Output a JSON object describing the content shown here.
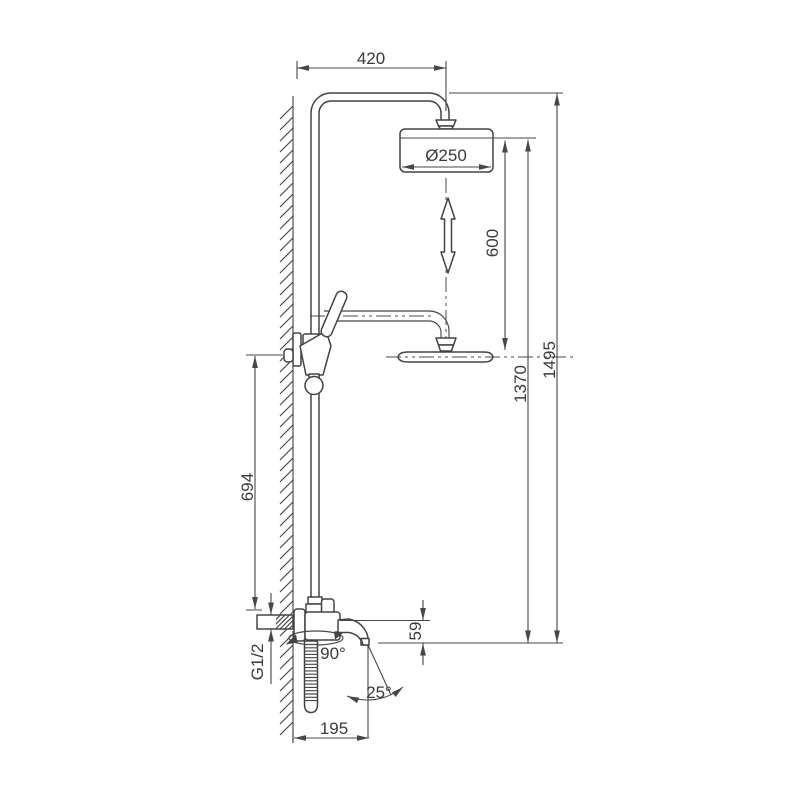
{
  "drawing": {
    "title": "shower-column-dimension-drawing",
    "background": "#ffffff",
    "line_color": "#434343",
    "dimensions": {
      "arm_reach": "420",
      "head_diameter": "Ø250",
      "height_adjustment": "600",
      "head_height": "1370",
      "total_height": "1495",
      "bracket_height": "694",
      "spout_drop": "59",
      "thread_size": "G1/2",
      "spout_swivel": "90°",
      "spout_tilt": "25°",
      "spout_reach": "195"
    }
  }
}
